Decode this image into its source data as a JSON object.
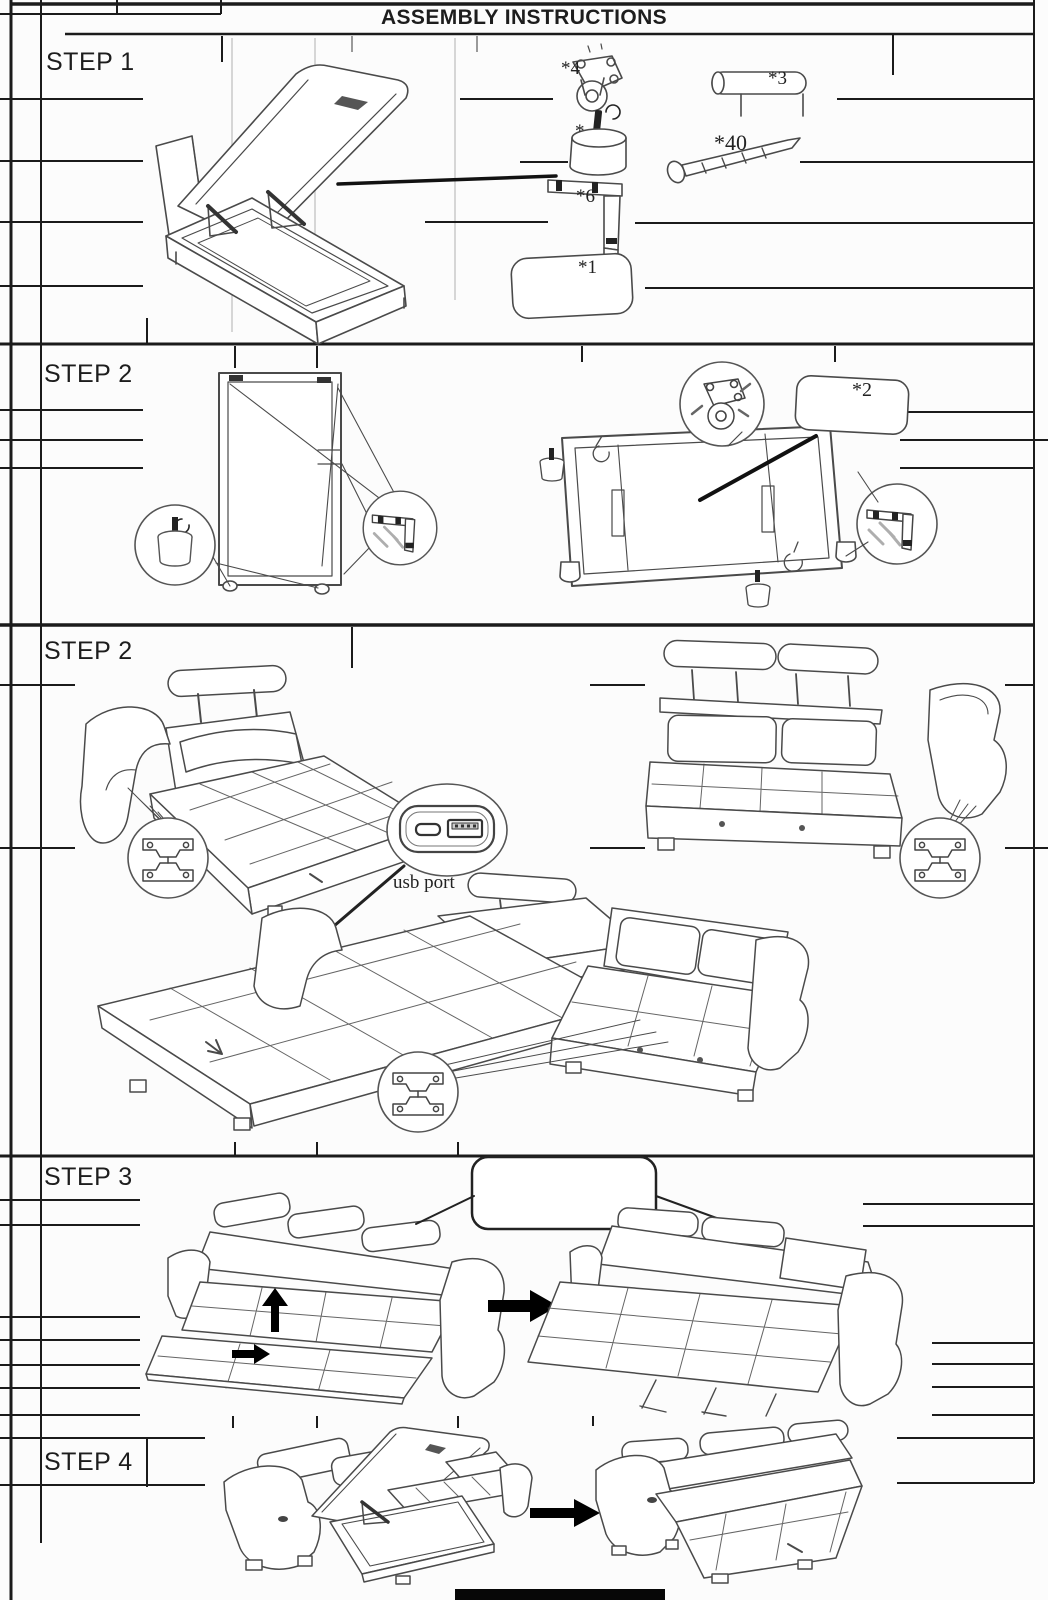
{
  "page": {
    "title": "ASSEMBLY INSTRUCTIONS"
  },
  "steps": [
    {
      "id": "step-1",
      "label": "STEP 1"
    },
    {
      "id": "step-2a",
      "label": "STEP 2"
    },
    {
      "id": "step-2b",
      "label": "STEP 2"
    },
    {
      "id": "step-3",
      "label": "STEP 3"
    },
    {
      "id": "step-4",
      "label": "STEP 4"
    }
  ],
  "parts": {
    "caster": {
      "label": "*4"
    },
    "leg_rail": {
      "label": "*3"
    },
    "round_leg": {
      "label": "*"
    },
    "screws": {
      "label": "*40"
    },
    "bracket": {
      "label": "*6"
    },
    "pillow_left": {
      "label": "*1"
    },
    "pillow_right": {
      "label": "*2"
    }
  },
  "callouts": {
    "usb_port": "usb port"
  },
  "colors": {
    "ink": "#1b1b1b",
    "art_line": "#4a4a4a",
    "paper": "#fcfcfc"
  }
}
